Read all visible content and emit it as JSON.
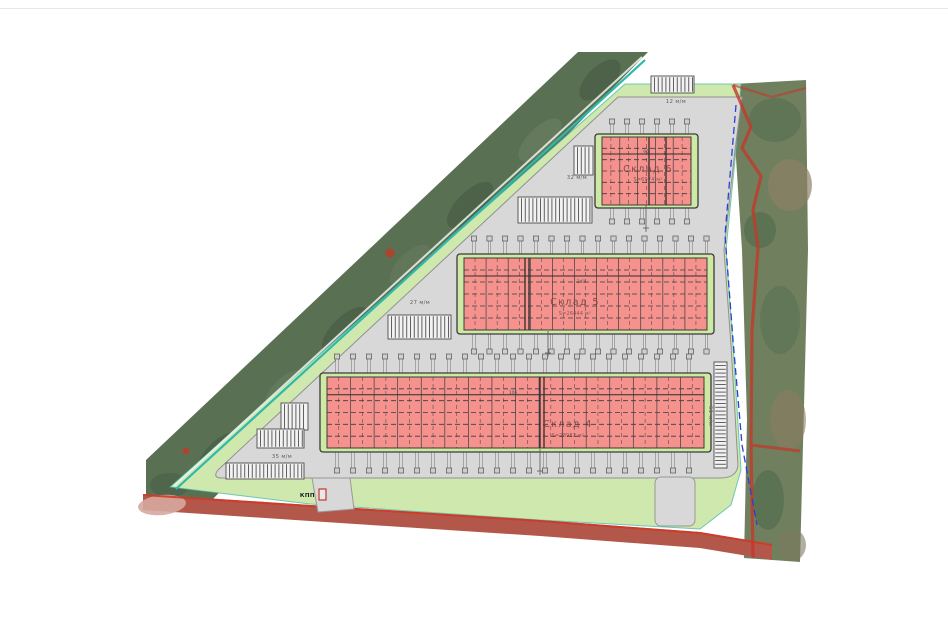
{
  "plan": {
    "warehouses": [
      {
        "name": "Склад 4",
        "area": "S=28982 м²",
        "dim": "106"
      },
      {
        "name": "Склад 5",
        "area": "S=26444 м²",
        "dim": "240"
      },
      {
        "name": "Склад 6",
        "area": "S=6974 м²",
        "dim": "96"
      }
    ],
    "parking": [
      {
        "id": "top",
        "label": "12 м/м"
      },
      {
        "id": "sklad6",
        "label": "32 м/м"
      },
      {
        "id": "sklad5",
        "label": "27 м/м"
      },
      {
        "id": "sklad4",
        "label": "35 м/м"
      },
      {
        "id": "right",
        "label": "61 м/м"
      }
    ],
    "checkpoint_label": "КПП",
    "colors": {
      "warehouse_fill": "#f5928e",
      "warehouse_cap": "#cde9a4",
      "grass": "#cfe8ad",
      "pavement": "#d8d8d8",
      "forest": "#5a7053",
      "boundary_teal": "#2fb8ab",
      "cadastral_red": "#c0392b",
      "utility_blue": "#2b3fd4",
      "road": "#b2574a"
    }
  }
}
